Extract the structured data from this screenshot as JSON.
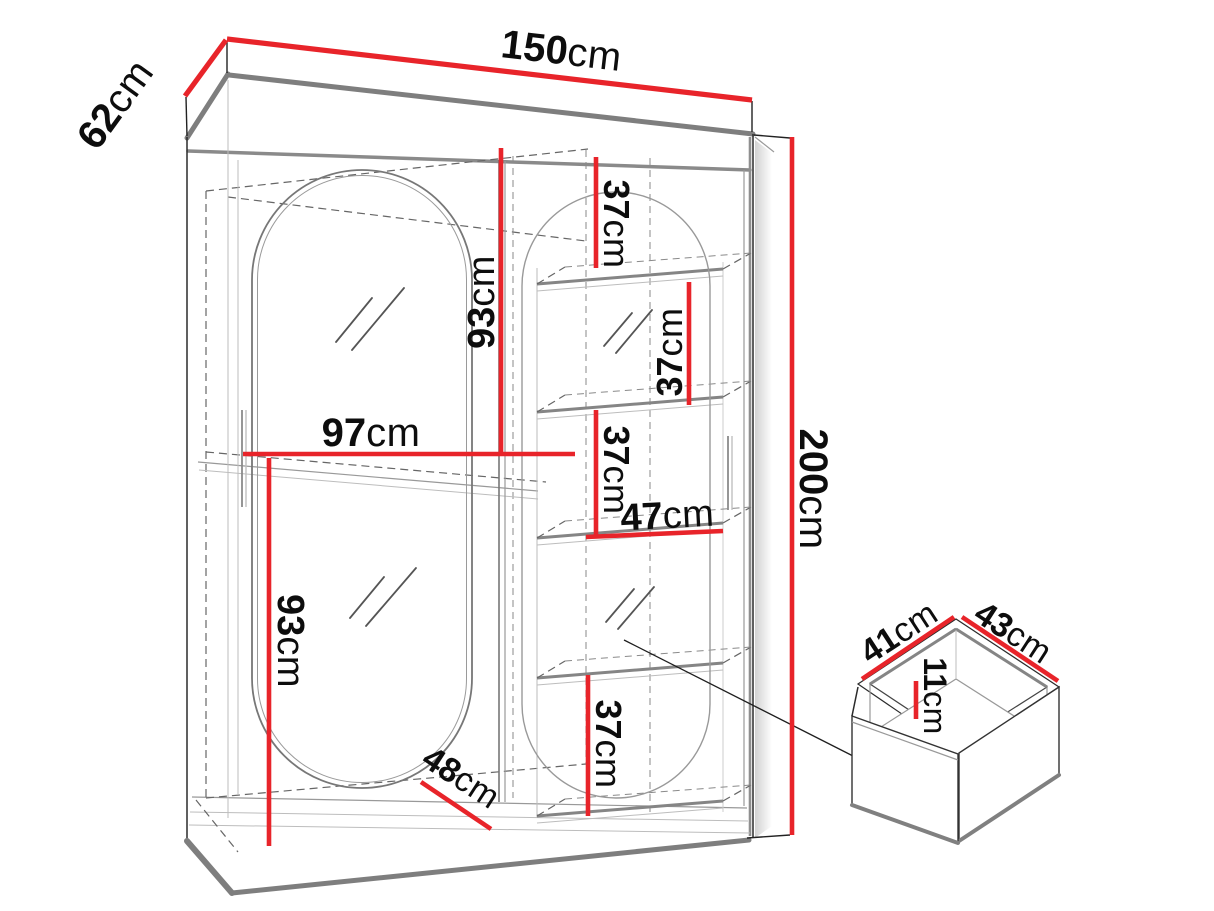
{
  "diagram": {
    "dimensions": {
      "width": {
        "value": "150",
        "unit": "cm"
      },
      "depth": {
        "value": "62",
        "unit": "cm"
      },
      "height": {
        "value": "200",
        "unit": "cm"
      },
      "left_section_width": {
        "value": "97",
        "unit": "cm"
      },
      "upper_left_height": {
        "value": "93",
        "unit": "cm"
      },
      "lower_left_height": {
        "value": "93",
        "unit": "cm"
      },
      "shelf_gap_1": {
        "value": "37",
        "unit": "cm"
      },
      "shelf_gap_2": {
        "value": "37",
        "unit": "cm"
      },
      "shelf_gap_3": {
        "value": "37",
        "unit": "cm"
      },
      "shelf_gap_4": {
        "value": "37",
        "unit": "cm"
      },
      "shelf_width": {
        "value": "47",
        "unit": "cm"
      },
      "base_diagonal": {
        "value": "48",
        "unit": "cm"
      },
      "drawer_depth": {
        "value": "41",
        "unit": "cm"
      },
      "drawer_width": {
        "value": "43",
        "unit": "cm"
      },
      "drawer_height": {
        "value": "11",
        "unit": "cm"
      }
    }
  }
}
